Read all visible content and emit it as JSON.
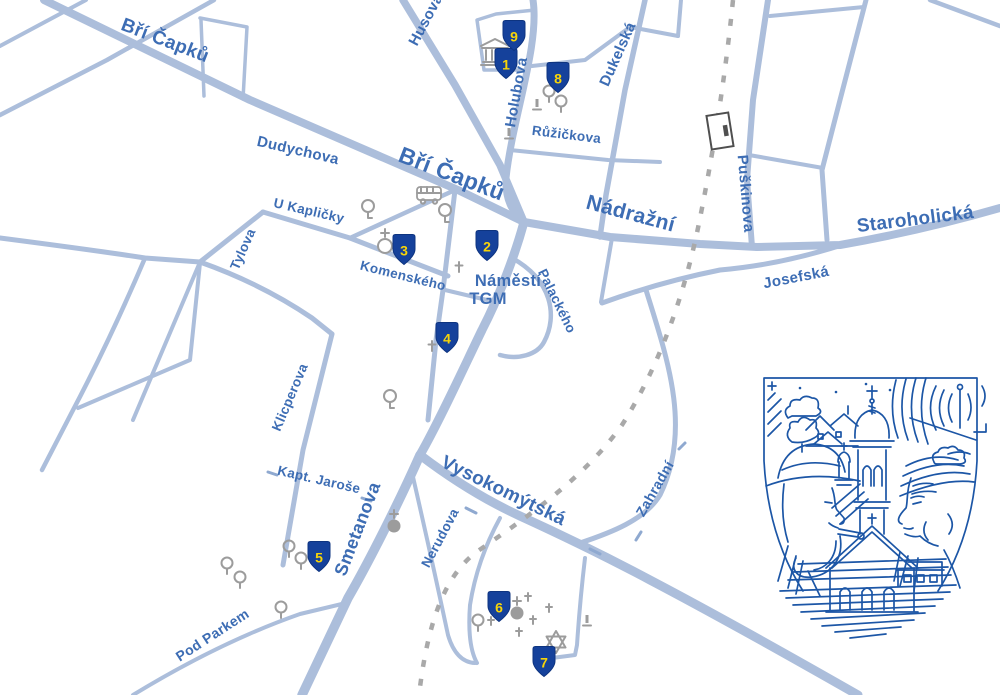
{
  "colors": {
    "background": "#ffffff",
    "street": "#acbedb",
    "street_label": "#3d6db4",
    "railway": "#a9a9a9",
    "marker_shield": "#15419b",
    "marker_number": "#f7d408",
    "poi_icon_gray": "#9c9c9c",
    "station_outline": "#4f4f4f",
    "emblem_line": "#1c56a6"
  },
  "street_labels": [
    {
      "id": "bri-capku-nw",
      "text": "Bří Čapků"
    },
    {
      "id": "husova",
      "text": "Husova"
    },
    {
      "id": "holubova",
      "text": "Holubova"
    },
    {
      "id": "ruzickova",
      "text": "Růžičkova"
    },
    {
      "id": "dukelska",
      "text": "Dukelská"
    },
    {
      "id": "puskinova",
      "text": "Puškinova"
    },
    {
      "id": "dudychova",
      "text": "Dudychova"
    },
    {
      "id": "bri-capku-center",
      "text": "Bří Čapků"
    },
    {
      "id": "nadrazni",
      "text": "Nádražní"
    },
    {
      "id": "staroholicka",
      "text": "Staroholická"
    },
    {
      "id": "josefska",
      "text": "Josefská"
    },
    {
      "id": "u-kaplicky",
      "text": "U Kapličky"
    },
    {
      "id": "tylova",
      "text": "Tylova"
    },
    {
      "id": "komenskeho",
      "text": "Komenského"
    },
    {
      "id": "palackeho",
      "text": "Palackého"
    },
    {
      "id": "klicperova",
      "text": "Klicperova"
    },
    {
      "id": "kapt-jarose",
      "text": "Kapt. Jaroše"
    },
    {
      "id": "smetanova",
      "text": "Smetanova"
    },
    {
      "id": "vysokomytska",
      "text": "Vysokomýtská"
    },
    {
      "id": "nerudova",
      "text": "Nerudova"
    },
    {
      "id": "zahradni",
      "text": "Zahradní"
    },
    {
      "id": "pod-parkem",
      "text": "Pod Parkem"
    }
  ],
  "square_label": {
    "line1": "Náměstí",
    "line2": "TGM"
  },
  "markers": [
    {
      "number": "1"
    },
    {
      "number": "2"
    },
    {
      "number": "3"
    },
    {
      "number": "4"
    },
    {
      "number": "5"
    },
    {
      "number": "6"
    },
    {
      "number": "7"
    },
    {
      "number": "8"
    },
    {
      "number": "9"
    }
  ],
  "icons": {
    "marker": "numbered-shield-marker",
    "museum": "museum-icon",
    "bus": "bus-stop-icon",
    "chapel": "chapel-icon",
    "church": "church-icon",
    "grave_cross": "grave-cross-icon",
    "tree": "tree-icon",
    "monument": "monument-icon",
    "star_of_david": "star-of-david-icon",
    "railway_station": "railway-station-icon",
    "railway": "railway-dashed-line",
    "emblem": "holice-town-emblem"
  }
}
